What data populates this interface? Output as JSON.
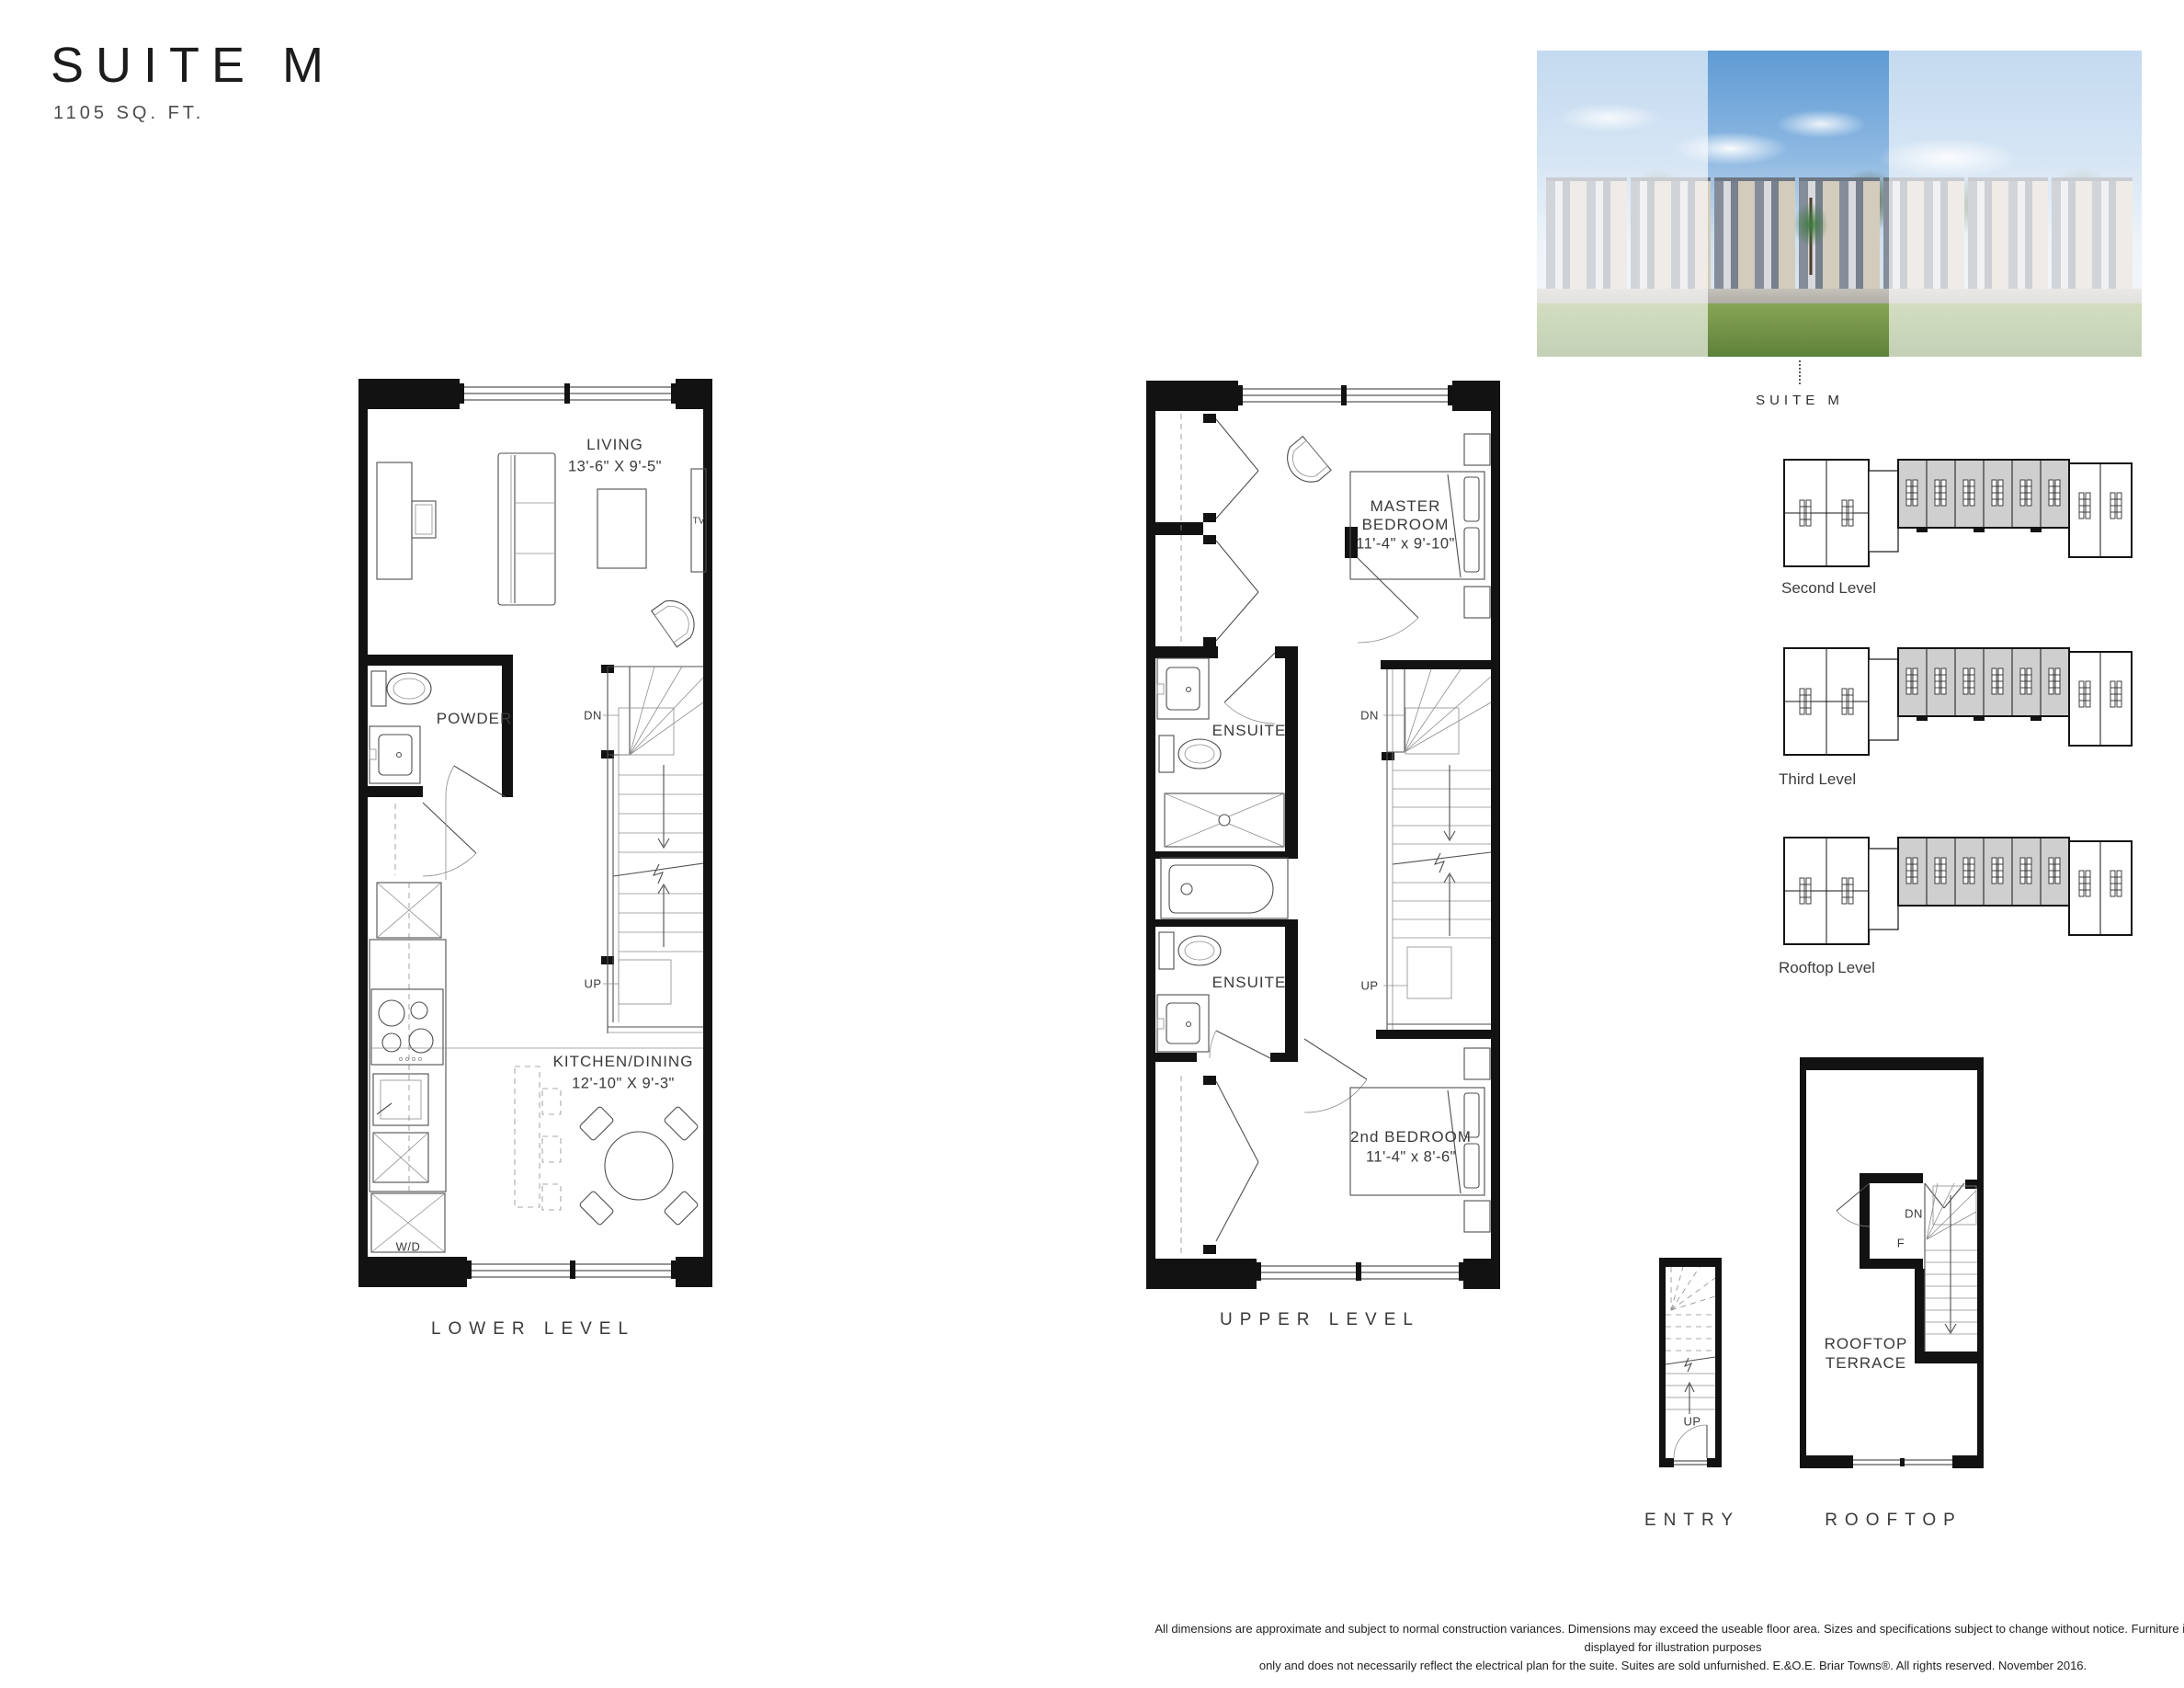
{
  "header": {
    "title": "SUITE M",
    "area": "1105 SQ. FT."
  },
  "rendering": {
    "caption": "SUITE M"
  },
  "keyplans": [
    {
      "label": "Second Level"
    },
    {
      "label": "Third Level"
    },
    {
      "label": "Rooftop Level"
    }
  ],
  "plans": {
    "lower": {
      "caption": "LOWER LEVEL",
      "living": {
        "name": "LIVING",
        "dims": "13'-6\" X 9'-5\""
      },
      "tv": "TV",
      "powder": "POWDER",
      "dn": "DN",
      "up": "UP",
      "kitchen": {
        "name": "KITCHEN/DINING",
        "dims": "12'-10\" X 9'-3\""
      },
      "wd": "W/D"
    },
    "upper": {
      "caption": "UPPER LEVEL",
      "master": {
        "line1": "MASTER",
        "line2": "BEDROOM",
        "dims": "11'-4\" x 9'-10\""
      },
      "ensuite_upper": "ENSUITE",
      "ensuite_lower": "ENSUITE",
      "dn": "DN",
      "up": "UP",
      "bedroom2": {
        "name": "2nd BEDROOM",
        "dims": "11'-4\" x 8'-6\""
      }
    },
    "entry": {
      "caption": "ENTRY",
      "up": "UP"
    },
    "rooftop": {
      "caption": "ROOFTOP",
      "terrace_line1": "ROOFTOP",
      "terrace_line2": "TERRACE",
      "dn": "DN",
      "f": "F"
    }
  },
  "disclaimer": {
    "line1": "All dimensions are approximate and subject to normal construction variances. Dimensions may exceed the useable floor area. Sizes and specifications subject to change without notice. Furniture is displayed for illustration purposes",
    "line2": "only and does not necessarily reflect the electrical plan for the suite. Suites are sold unfurnished. E.&O.E. Briar Towns®. All rights reserved. November 2016."
  },
  "colors": {
    "ink": "#121212",
    "line": "#4f4f4f",
    "keyplan_shade": "#cfcfcf"
  }
}
